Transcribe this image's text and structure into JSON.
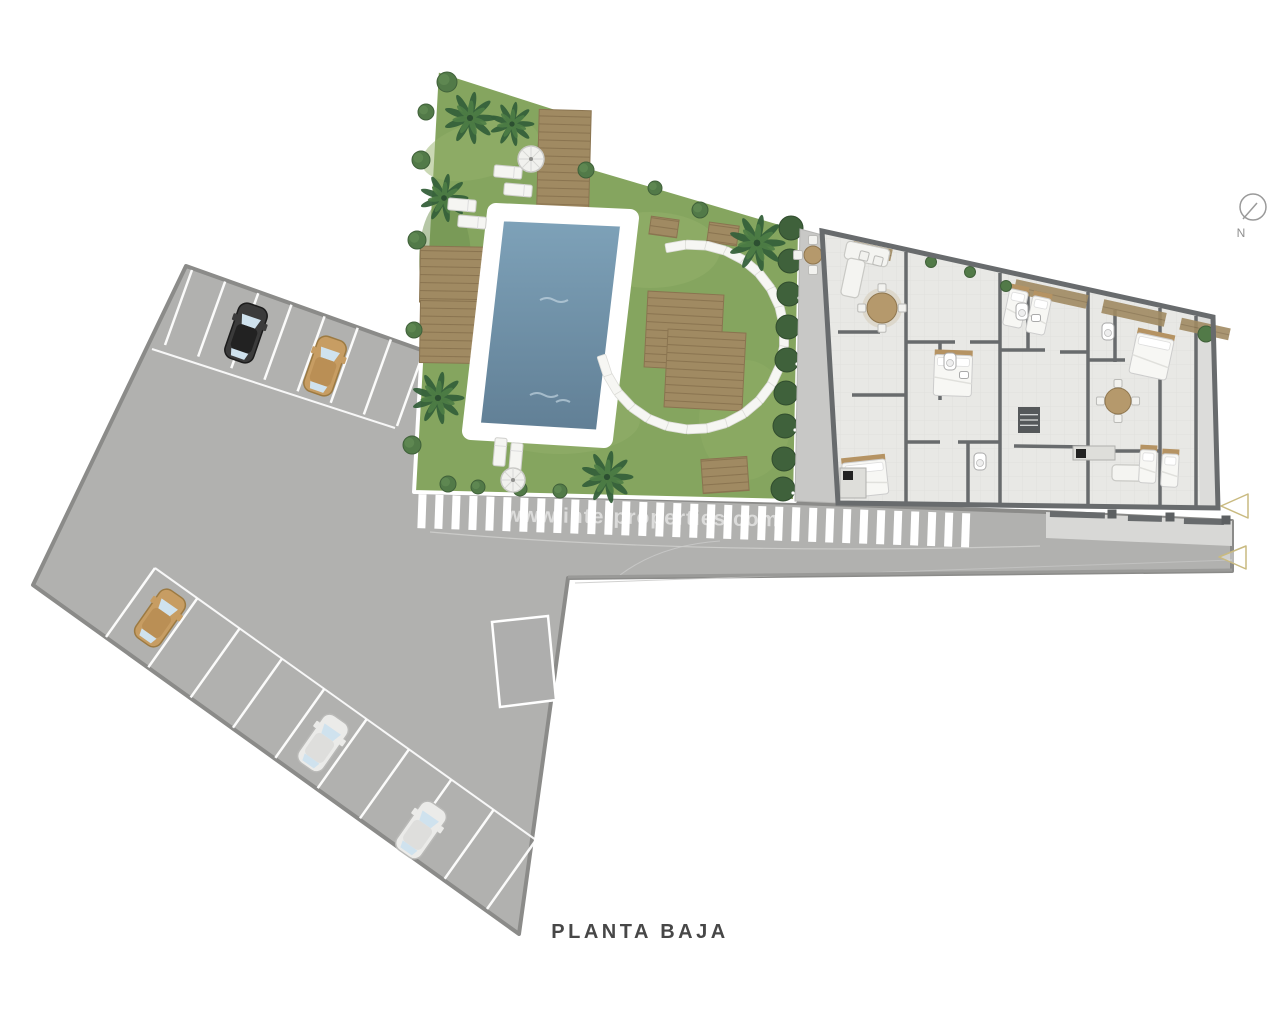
{
  "title": {
    "label": "PLANTA BAJA"
  },
  "compass": {
    "label": "N"
  },
  "watermark": {
    "text": "www.interproperties.com"
  },
  "colors": {
    "pavement": "#b1b1af",
    "pavementBorder": "#8b8b89",
    "sidewalk": "#d8d8d6",
    "grass": "#85a55f",
    "deck": "#a08a62",
    "deckLine": "#8a7450",
    "poolTop": "#7fa3ba",
    "poolBottom": "#607e94",
    "coping": "#ffffff",
    "wall": "#686b6d",
    "floor": "#e8e8e5",
    "terrace": "#c8c8c6",
    "hedge": "#3f613b",
    "palm": "#35603a",
    "palmLight": "#4e7d45",
    "bush": "#527a48",
    "carBlack": "#3b3b3b",
    "carTan": "#c79d63",
    "carWhite": "#ebebe9",
    "window": "#cfe2ee",
    "marking": "#ffffff",
    "arrow": "#c9ba80",
    "textDark": "#474747",
    "north": "#9a9a9a"
  },
  "parking": {
    "cars": [
      {
        "color": "black",
        "x": 246,
        "y": 333,
        "rot": 19
      },
      {
        "color": "tan",
        "x": 325,
        "y": 366,
        "rot": 19
      },
      {
        "color": "tan",
        "x": 160,
        "y": 618,
        "rot": 35
      },
      {
        "color": "white",
        "x": 323,
        "y": 743,
        "rot": 35
      },
      {
        "color": "white",
        "x": 421,
        "y": 830,
        "rot": 35
      }
    ],
    "bayRows": [
      {
        "x1": 192,
        "y1": 270,
        "x2": 424,
        "y2": 351,
        "lines": 8,
        "dx": -27,
        "dy": 75
      },
      {
        "x1": 106,
        "y1": 637,
        "x2": 487,
        "y2": 909,
        "lines": 10,
        "dx": 49,
        "dy": -69
      }
    ],
    "frontLines": [
      [
        152,
        349,
        395,
        428
      ],
      [
        155,
        568,
        536,
        840
      ]
    ],
    "specialBay": [
      [
        492,
        622
      ],
      [
        548,
        616
      ],
      [
        556,
        700
      ],
      [
        500,
        707
      ]
    ]
  },
  "crosswalk": {
    "x1": 418,
    "x2": 978,
    "y": 494,
    "h": 34,
    "w": 8,
    "gap": 9,
    "rot": 2,
    "cx": 415,
    "cy": 510
  },
  "garden": {
    "palms": [
      [
        470,
        118,
        26
      ],
      [
        512,
        124,
        22
      ],
      [
        444,
        198,
        24
      ],
      [
        438,
        398,
        26
      ],
      [
        607,
        477,
        26
      ],
      [
        757,
        243,
        28
      ]
    ],
    "bushes": [
      [
        447,
        82,
        10
      ],
      [
        426,
        112,
        8
      ],
      [
        421,
        160,
        9
      ],
      [
        417,
        240,
        9
      ],
      [
        414,
        330,
        8
      ],
      [
        412,
        445,
        9
      ],
      [
        448,
        484,
        8
      ],
      [
        478,
        487,
        7
      ],
      [
        520,
        489,
        7
      ],
      [
        560,
        491,
        7
      ],
      [
        655,
        188,
        7
      ],
      [
        700,
        210,
        8
      ],
      [
        586,
        170,
        8
      ]
    ],
    "hedge": [
      [
        791,
        228
      ],
      [
        790,
        261
      ],
      [
        789,
        294
      ],
      [
        788,
        327
      ],
      [
        787,
        360
      ],
      [
        786,
        393
      ],
      [
        785,
        426
      ],
      [
        784,
        459
      ],
      [
        783,
        489
      ]
    ],
    "parasols": [
      [
        531,
        159,
        13
      ],
      [
        513,
        480,
        12
      ]
    ],
    "loungers": [
      [
        508,
        172,
        95
      ],
      [
        518,
        190,
        95
      ],
      [
        462,
        205,
        95
      ],
      [
        472,
        222,
        95
      ],
      [
        500,
        452,
        5
      ],
      [
        516,
        457,
        5
      ]
    ],
    "decks": [
      {
        "x": 563,
        "y": 196,
        "w": 52,
        "h": 172,
        "rot": 1.5
      },
      {
        "x": 476,
        "y": 275,
        "w": 112,
        "h": 56,
        "rot": 1
      },
      {
        "x": 449,
        "y": 332,
        "w": 58,
        "h": 62,
        "rot": 1
      },
      {
        "x": 684,
        "y": 331,
        "w": 76,
        "h": 76,
        "rot": 3
      },
      {
        "x": 705,
        "y": 370,
        "w": 78,
        "h": 78,
        "rot": 3
      },
      {
        "x": 664,
        "y": 227,
        "w": 28,
        "h": 18,
        "rot": 8
      },
      {
        "x": 723,
        "y": 234,
        "w": 30,
        "h": 20,
        "rot": 8
      },
      {
        "x": 725,
        "y": 475,
        "w": 46,
        "h": 34,
        "rot": -4
      }
    ],
    "stones": {
      "cx": 692,
      "cy": 337,
      "r": 92,
      "startDeg": -100,
      "endDeg": 162,
      "count": 22
    },
    "terraceTable": {
      "x": 813,
      "y": 255,
      "r": 9
    }
  },
  "building": {
    "innerWalls": [
      [
        906,
        252,
        906,
        503
      ],
      [
        1000,
        273,
        1000,
        504
      ],
      [
        1088,
        292,
        1088,
        505
      ],
      [
        1160,
        308,
        1160,
        506
      ],
      [
        838,
        332,
        880,
        332
      ],
      [
        852,
        395,
        906,
        395
      ],
      [
        906,
        342,
        955,
        342
      ],
      [
        970,
        342,
        1000,
        342
      ],
      [
        906,
        442,
        940,
        442
      ],
      [
        958,
        442,
        1000,
        442
      ],
      [
        1000,
        350,
        1045,
        350
      ],
      [
        1060,
        352,
        1088,
        352
      ],
      [
        1014,
        446,
        1088,
        447
      ],
      [
        1088,
        360,
        1125,
        360
      ],
      [
        1100,
        451,
        1160,
        451
      ],
      [
        940,
        342,
        940,
        400
      ],
      [
        1028,
        292,
        1028,
        350
      ],
      [
        1115,
        310,
        1115,
        362
      ],
      [
        968,
        442,
        968,
        503
      ],
      [
        1196,
        316,
        1196,
        507
      ]
    ],
    "pergolas": [
      [
        872,
        251,
        40,
        12
      ],
      [
        1051,
        294,
        74,
        14
      ],
      [
        1134,
        313,
        64,
        14
      ],
      [
        1205,
        329,
        50,
        12
      ]
    ],
    "beds": [
      {
        "x": 865,
        "y": 476,
        "w": 44,
        "h": 40,
        "rot": -6
      },
      {
        "x": 1016,
        "y": 306,
        "w": 19,
        "h": 42,
        "rot": 12
      },
      {
        "x": 1039,
        "y": 313,
        "w": 19,
        "h": 42,
        "rot": 12
      },
      {
        "x": 1152,
        "y": 354,
        "w": 38,
        "h": 46,
        "rot": 12
      },
      {
        "x": 953,
        "y": 373,
        "w": 38,
        "h": 46,
        "rot": 2
      },
      {
        "x": 1148,
        "y": 464,
        "w": 17,
        "h": 38,
        "rot": 3
      },
      {
        "x": 1170,
        "y": 468,
        "w": 17,
        "h": 38,
        "rot": 3
      }
    ],
    "sofas": [
      {
        "x": 867,
        "y": 254,
        "w": 44,
        "h": 18,
        "rot": 12
      },
      {
        "x": 853,
        "y": 278,
        "w": 18,
        "h": 38,
        "rot": 12
      },
      {
        "x": 1130,
        "y": 473,
        "w": 36,
        "h": 16,
        "rot": 1
      }
    ],
    "tables": [
      {
        "x": 882,
        "y": 308,
        "r": 15
      },
      {
        "x": 1118,
        "y": 401,
        "r": 13
      }
    ],
    "baths": [
      [
        950,
        362
      ],
      [
        1022,
        312
      ],
      [
        1108,
        332
      ],
      [
        980,
        462
      ]
    ],
    "sinks": [
      [
        964,
        375
      ],
      [
        1036,
        318
      ]
    ],
    "kitchens": [
      {
        "x": 853,
        "y": 483,
        "w": 26,
        "h": 30
      },
      {
        "x": 1094,
        "y": 453,
        "w": 42,
        "h": 14
      }
    ],
    "stair": {
      "x": 1029,
      "y": 420,
      "w": 22,
      "h": 26
    },
    "plant": [
      1206,
      334,
      8
    ],
    "terraceBushes": [
      [
        931,
        262
      ],
      [
        970,
        272
      ],
      [
        1006,
        286
      ]
    ],
    "terraceChairs": [
      [
        864,
        256
      ],
      [
        878,
        261
      ]
    ]
  },
  "roadside": {
    "wallSegs": [
      [
        1050,
        511,
        55
      ],
      [
        1128,
        515,
        34
      ],
      [
        1184,
        518,
        40
      ]
    ],
    "pillars": [
      [
        1112,
        514
      ],
      [
        1170,
        517
      ],
      [
        1226,
        520
      ]
    ],
    "arrows": [
      {
        "points": "1221,506 1248,494 1248,518"
      },
      {
        "points": "1219,557 1246,546 1246,569"
      }
    ]
  }
}
